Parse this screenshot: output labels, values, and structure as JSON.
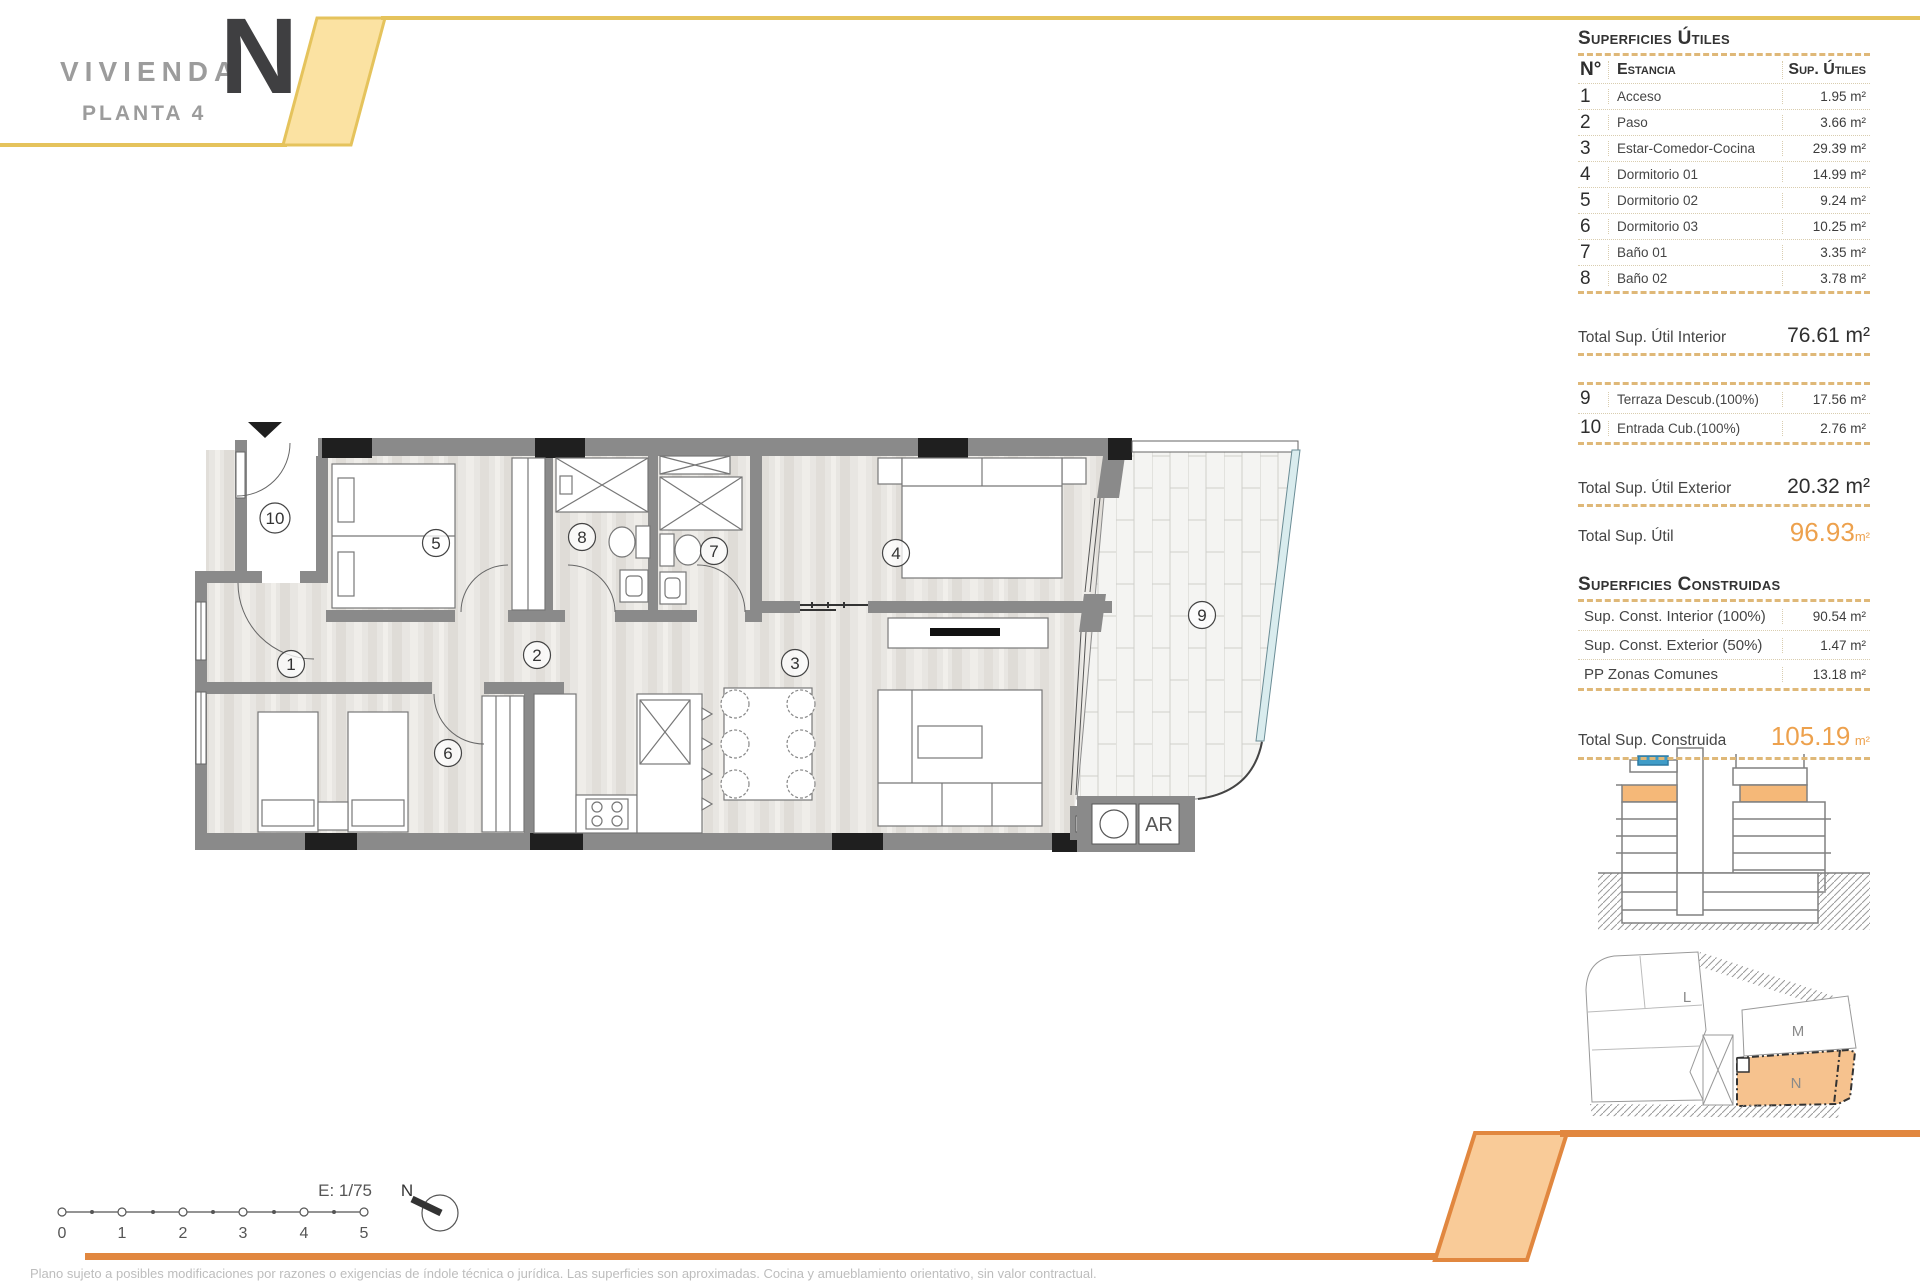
{
  "header": {
    "title": "VIVIENDA",
    "unit_letter": "N",
    "subtitle": "PLANTA 4"
  },
  "surfaces_utiles": {
    "title": "Superficies Útiles",
    "columns": {
      "num": "N°",
      "room": "Estancia",
      "area": "Sup. Útiles"
    },
    "rows": [
      {
        "num": "1",
        "name": "Acceso",
        "area": "1.95 m²"
      },
      {
        "num": "2",
        "name": "Paso",
        "area": "3.66 m²"
      },
      {
        "num": "3",
        "name": "Estar-Comedor-Cocina",
        "area": "29.39 m²"
      },
      {
        "num": "4",
        "name": "Dormitorio 01",
        "area": "14.99 m²"
      },
      {
        "num": "5",
        "name": "Dormitorio 02",
        "area": "9.24 m²"
      },
      {
        "num": "6",
        "name": "Dormitorio 03",
        "area": "10.25 m²"
      },
      {
        "num": "7",
        "name": "Baño 01",
        "area": "3.35 m²"
      },
      {
        "num": "8",
        "name": "Baño 02",
        "area": "3.78 m²"
      }
    ],
    "total_interior": {
      "label": "Total Sup. Útil Interior",
      "value": "76.61 m²"
    },
    "exterior_rows": [
      {
        "num": "9",
        "name": "Terraza Descub.(100%)",
        "area": "17.56 m²"
      },
      {
        "num": "10",
        "name": "Entrada Cub.(100%)",
        "area": "2.76 m²"
      }
    ],
    "total_exterior": {
      "label": "Total Sup. Útil Exterior",
      "value": "20.32 m²"
    },
    "total": {
      "label": "Total Sup. Útil",
      "value": "96.93",
      "unit": "m²"
    }
  },
  "surfaces_construidas": {
    "title": "Superficies Construidas",
    "rows": [
      {
        "name": "Sup. Const. Interior (100%)",
        "area": "90.54 m²"
      },
      {
        "name": "Sup. Const. Exterior (50%)",
        "area": "1.47 m²"
      },
      {
        "name": "PP Zonas Comunes",
        "area": "13.18 m²"
      }
    ],
    "total": {
      "label": "Total Sup. Construida",
      "value": "105.19",
      "unit": "m²"
    }
  },
  "floor_plan": {
    "room_labels": {
      "r1": "1",
      "r2": "2",
      "r3": "3",
      "r4": "4",
      "r5": "5",
      "r6": "6",
      "r7": "7",
      "r8": "8",
      "r9": "9",
      "r10": "10"
    },
    "utility_label": "AR"
  },
  "scale_bar": {
    "scale_label": "E: 1/75",
    "ticks": [
      "0",
      "1",
      "2",
      "3",
      "4",
      "5"
    ],
    "north_label": "N"
  },
  "site_plan": {
    "labels": {
      "l": "L",
      "m": "M",
      "n": "N"
    }
  },
  "footer": {
    "disclaimer": "Plano sujeto a posibles modificaciones por razones o exigencias de índole técnica o jurídica. Las superficies son aproximadas. Cocina y amueblamiento orientativo, sin valor contractual."
  },
  "colors": {
    "accent_yellow": "#FBE2A2",
    "accent_orange": "#E1873F",
    "highlight_orange": "#EDA14D",
    "table_border": "#DFB878",
    "glass_blue": "#D9ECEE",
    "floor_highlight": "#F5B878"
  }
}
